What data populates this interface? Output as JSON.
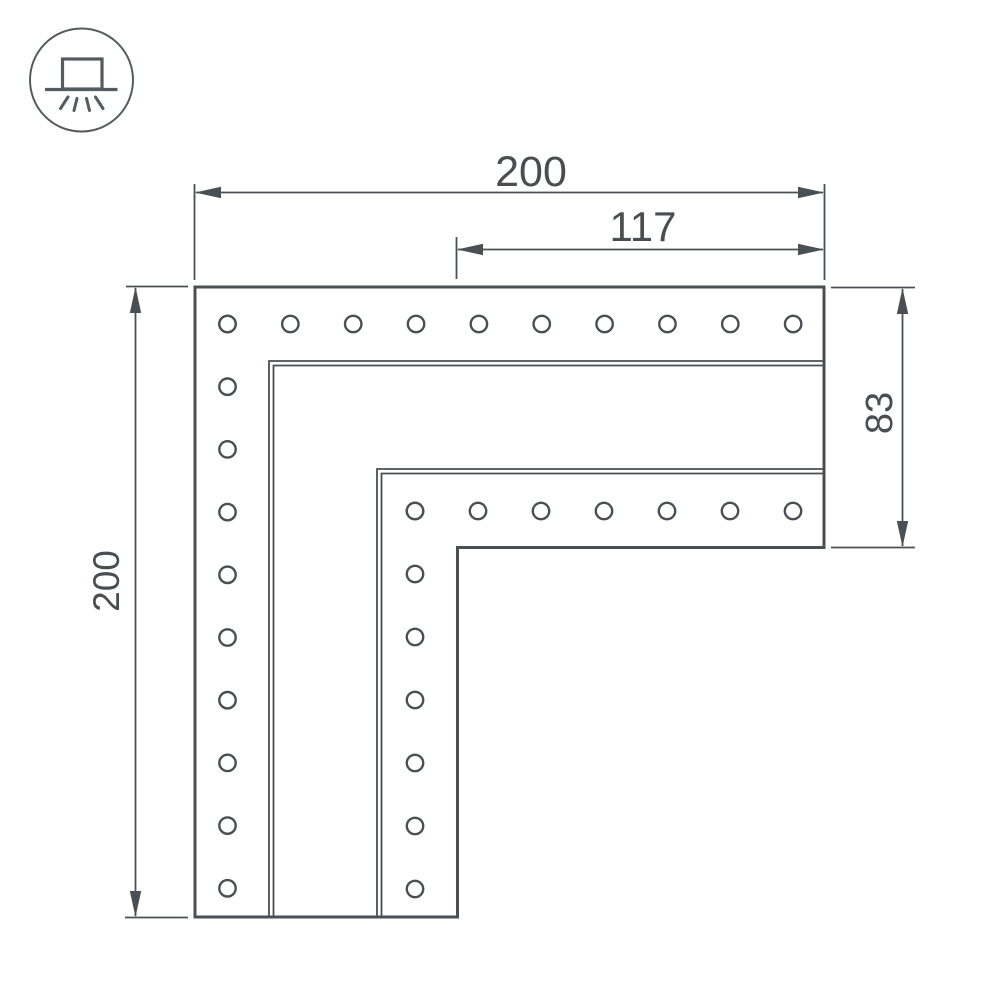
{
  "drawing": {
    "title": "L-shaped corner connector — dimensional drawing",
    "background": "#ffffff"
  },
  "icon": {
    "name": "surface-mount-light-icon",
    "meaning": "surface mounted luminaire (box on ceiling line with light rays below)"
  },
  "colors": {
    "line": "#4a4f54",
    "text": "#494e53",
    "icon": "#565b60",
    "background": "#ffffff"
  },
  "dimensions": {
    "width_total": {
      "label": "200",
      "value": 200,
      "orientation": "horizontal",
      "position": "top"
    },
    "width_inner": {
      "label": "117",
      "value": 117,
      "orientation": "horizontal",
      "position": "top-inner"
    },
    "height_total": {
      "label": "200",
      "value": 200,
      "orientation": "vertical",
      "position": "left"
    },
    "height_right": {
      "label": "83",
      "value": 83,
      "orientation": "vertical",
      "position": "right"
    }
  },
  "holes": {
    "radius": 8.2,
    "rows": [
      {
        "name": "outer-top-row",
        "axis": "x",
        "fixed": 324,
        "start": 227.5,
        "spacing": 62.85,
        "count": 10
      },
      {
        "name": "outer-left-column",
        "axis": "y",
        "fixed": 227.5,
        "start": 324,
        "spacing": 62.7,
        "count": 10
      },
      {
        "name": "inner-top-row",
        "axis": "x",
        "fixed": 511,
        "start": 415,
        "spacing": 63,
        "count": 7
      },
      {
        "name": "inner-left-column",
        "axis": "y",
        "fixed": 415,
        "start": 511,
        "spacing": 63,
        "count": 7
      }
    ]
  }
}
